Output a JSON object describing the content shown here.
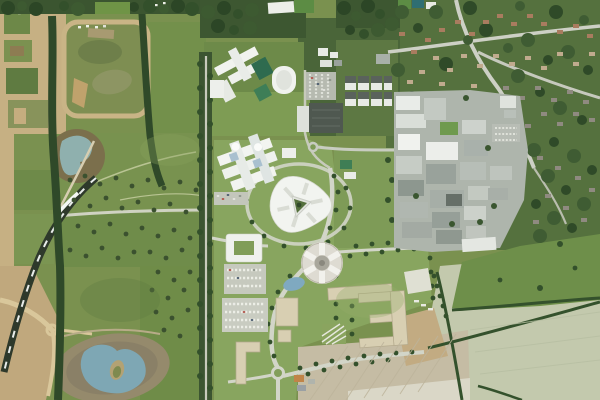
{
  "image": {
    "kind": "aerial-photograph-with-masterplan-render",
    "width_px": 600,
    "height_px": 400
  },
  "palette": {
    "field_base": "#7a914f",
    "field_bright": "#85a15e",
    "field_school": "#7e9c54",
    "field_dark": "#6f8c4a",
    "lawn_render": "#88a55f",
    "pasture_green": "#6e8f4a",
    "suburb_base": "#55713e",
    "tree_dark": "#2c4626",
    "tree_mid": "#3a5730",
    "tree_soft": "#43603666",
    "campus_trees": "#4a6539",
    "farmland_pale": "#c3c9ad",
    "ploughed_pale": "#c5bca4",
    "field_white": "#dad7c7",
    "field_tan": "#c2ab82",
    "construction_tan": "#c6b083",
    "dirt_brown": "#7b6f4c",
    "grade_grey": "#958a6c",
    "lake_blue": "#7ea7b4",
    "pond_blue": "#8fb0ae",
    "pond_small": "#7fa9c0",
    "road_light": "#cdd0c5",
    "road_pale": "#d2d5c8",
    "road_tan": "#d9c79b",
    "railway_dark": "#2e392b",
    "railway_dash": "#e8ecea",
    "building_white": "#f2f4f0",
    "building_offwhite": "#dde1da",
    "building_grey": "#aeb5ac",
    "building_midgrey": "#99a29b",
    "building_dark": "#4f5850",
    "masterplan_beige": "#d8cfb2",
    "beige_shadow": "#b3a98c",
    "hospital_base": "#aeb5ac",
    "court_green": "#2e6b4f",
    "court_green2": "#3e7e57",
    "court_teal": "#2f6e72",
    "pitch_green": "#5c8c44",
    "roof_green": "#6f9a4e",
    "glass_blue": "#a9c0cf",
    "house_red": "#a97c5f",
    "house_tan": "#c0ab8e",
    "house_grey": "#8f8a80",
    "car_red": "#b0483e",
    "car_blue": "#3d4f66",
    "car_white": "#e9eae5",
    "bus_orange": "#c08448"
  },
  "features": [
    {
      "name": "construction-zone-northwest",
      "kind": "earthworks and fenced building plots"
    },
    {
      "name": "construction-zone-southwest",
      "kind": "haul roads and graded earth"
    },
    {
      "name": "guided-busway",
      "kind": "dark rail/busway corridor with white dashes"
    },
    {
      "name": "tree-lined-corridor",
      "kind": "vertical tree-lined access road"
    },
    {
      "name": "upper-pond",
      "kind": "grey-blue balancing pond on bare earth"
    },
    {
      "name": "lower-lake",
      "kind": "blue lake with small island, graded shore"
    },
    {
      "name": "parkland",
      "kind": "fields with scattered young trees and footpaths"
    },
    {
      "name": "school-campus",
      "kind": "white buildings, dark green courts, oval sports hall"
    },
    {
      "name": "playing-field",
      "kind": "large mown sports field"
    },
    {
      "name": "staff-housing-rows",
      "kind": "paired rows of white/dark residential blocks"
    },
    {
      "name": "multi-storey-car-park",
      "kind": "dark rectangular parking structure"
    },
    {
      "name": "white-hospital-complex",
      "kind": "multi-wing white building with glass links"
    },
    {
      "name": "triangle-headquarters-building",
      "kind": "rounded triangular white building with planted courtyard"
    },
    {
      "name": "circular-building",
      "kind": "round building with radial white roof wedges"
    },
    {
      "name": "courtyard-building",
      "kind": "white block enclosing a green court"
    },
    {
      "name": "masterplan-blocks",
      "kind": "beige rendered E / L / bar shaped buildings"
    },
    {
      "name": "surface-parking",
      "kind": "car parks with marked bays and parked cars"
    },
    {
      "name": "hospital-campus",
      "kind": "dense grey and white hospital blocks with roundabout"
    },
    {
      "name": "residential-suburb",
      "kind": "tree-covered streets with small houses"
    },
    {
      "name": "pasture-field",
      "kind": "bright green pasture with lone trees"
    },
    {
      "name": "ploughed-fields",
      "kind": "pale cultivated fields with furrow lines"
    },
    {
      "name": "hedgerows",
      "kind": "dark field-boundary tree lines"
    },
    {
      "name": "roundabouts",
      "kind": "small circular road junctions"
    }
  ]
}
